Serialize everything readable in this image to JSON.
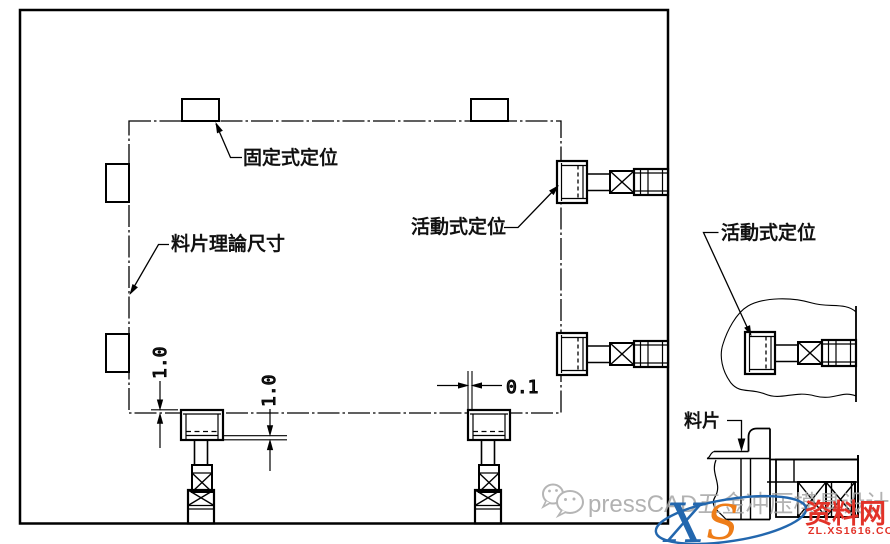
{
  "labels": {
    "fixed_locator": "固定式定位",
    "sheet_theoretical": "料片理論尺寸",
    "movable_locator": "活動式定位",
    "movable_locator_detail": "活動式定位",
    "strip": "料片"
  },
  "dimensions": {
    "tab_offset": "1.0",
    "slot_clearance": "1.0",
    "side_gap": "0.1"
  },
  "watermark": {
    "brand_text": "pressCAD五金冲压模具设计",
    "logo_x": "X",
    "logo_s": "S",
    "site_name": "资料网",
    "site_url": "ZL.XS1616.COM"
  },
  "colors": {
    "line": "#000000",
    "watermark_grey": "#a5a5a5",
    "logo_red": "#e23228",
    "logo_blue": "#2367ae",
    "logo_orange": "#ee7d18"
  }
}
